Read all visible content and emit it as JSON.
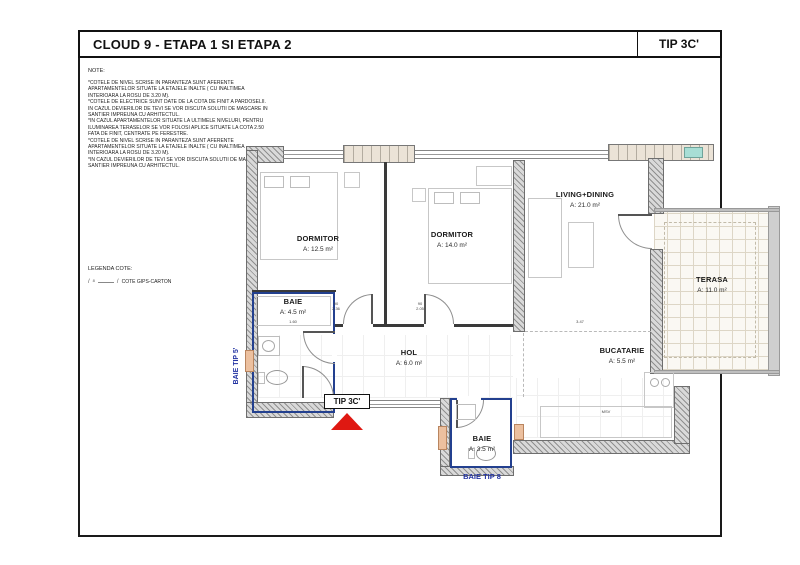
{
  "title_bar": {
    "project": "CLOUD 9 - ETAPA 1 SI ETAPA 2",
    "type_label": "TIP 3C'"
  },
  "note": {
    "heading": "NOTE:",
    "lines": [
      "*COTELE DE NIVEL SCRISE IN PARANTEZA SUNT AFERENTE",
      "APARTAMENTELOR SITUATE LA ETAJELE INALTE ( CU INALTIMEA",
      "INTERIOARA LA ROSU DE 3.20 M).",
      "*COTELE DE ELECTRICE SUNT DATE DE LA COTA DE FINIT A PARDOSELII.",
      "IN CAZUL DEVIERILOR DE TEVI SE VOR DISCUTA SOLUTII DE MASCARE IN",
      "SANTIER IMPREUNA CU ARHITECTUL.",
      "*IN CAZUL APARTAMENTELOR SITUATE LA ULTIMELE NIVELURI, PENTRU",
      "ILUMINAREA TERASELOR SE VOR FOLOSI APLICE SITUATE LA COTA 2.50",
      "FATA DE FINIT, CENTRATE PE FERESTRE.",
      "*COTELE DE NIVEL SCRISE IN PARANTEZA SUNT AFERENTE",
      "APARTAMENTELOR SITUATE LA ETAJELE INALTE ( CU INALTIMEA",
      "INTERIOARA LA ROSU DE 3.20 M).",
      "*IN CAZUL DEVIERILOR DE TEVI SE VOR DISCUTA SOLUTII DE MASCARE IN",
      "SANTIER IMPREUNA CU ARHITECTUL."
    ]
  },
  "legend": {
    "heading": "LEGENDA COTE:",
    "tick": "/",
    "number": "8",
    "item": "COTE GIPS-CARTON"
  },
  "plan": {
    "rooms": [
      {
        "id": "dormitor1",
        "name": "DORMITOR",
        "area": "A: 12.5 m²"
      },
      {
        "id": "dormitor2",
        "name": "DORMITOR",
        "area": "A: 14.0 m²"
      },
      {
        "id": "living",
        "name": "LIVING+DINING",
        "area": "A: 21.0 m²"
      },
      {
        "id": "terasa",
        "name": "TERASA",
        "area": "A: 11.0 m²"
      },
      {
        "id": "bucatarie",
        "name": "BUCATARIE",
        "area": "A: 5.5 m²"
      },
      {
        "id": "hol",
        "name": "HOL",
        "area": "A: 6.0 m²"
      },
      {
        "id": "baie1",
        "name": "BAIE",
        "area": "A: 4.5 m²"
      },
      {
        "id": "baie2",
        "name": "BAIE",
        "area": "A: 3.5 m²"
      }
    ],
    "markers": {
      "unit_label": "TIP 3C'",
      "baie_tip8": "BAIE  TIP 8",
      "baie_tip5": "BAIE  TIP 5'"
    },
    "dimensions": {
      "baie1_width": "1.60",
      "door1": [
        "90",
        "2.36"
      ],
      "door2": [
        "90",
        "2.05"
      ],
      "living_dim": "3.47",
      "kitchen_note": "MSV"
    },
    "colors": {
      "bath_outline": "#23408f",
      "label_blue": "#2333a2",
      "entrance_red": "#df1812",
      "wall_gray": "#8f8f8f",
      "window_teal": "#a8ded5"
    }
  }
}
